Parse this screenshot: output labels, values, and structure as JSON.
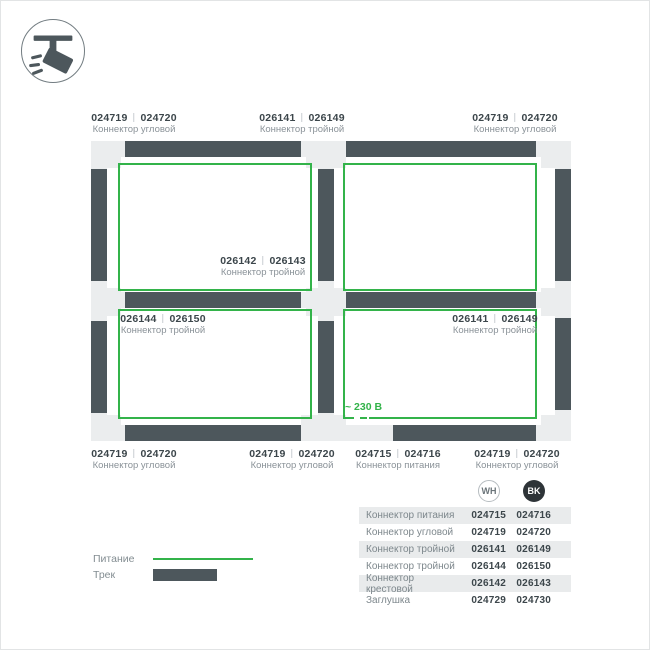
{
  "colors": {
    "power_green": "#33b34a",
    "track_dark": "#4d575c",
    "track_light": "#ebedee",
    "table_shade": "#e9ebec",
    "text_dark": "#3c464b",
    "text_gray": "#8a9298"
  },
  "icon": {
    "name": "track-spotlight"
  },
  "diagram": {
    "labels": [
      {
        "num1": "024719",
        "num2": "024720",
        "name": "Коннектор угловой"
      },
      {
        "num1": "026141",
        "num2": "026149",
        "name": "Коннектор тройной"
      },
      {
        "num1": "024719",
        "num2": "024720",
        "name": "Коннектор угловой"
      },
      {
        "num1": "026142",
        "num2": "026143",
        "name": "Коннектор тройной"
      },
      {
        "num1": "026144",
        "num2": "026150",
        "name": "Коннектор тройной"
      },
      {
        "num1": "026141",
        "num2": "026149",
        "name": "Коннектор тройной"
      },
      {
        "num1": "024719",
        "num2": "024720",
        "name": "Коннектор угловой"
      },
      {
        "num1": "024719",
        "num2": "024720",
        "name": "Коннектор угловой"
      },
      {
        "num1": "024715",
        "num2": "024716",
        "name": "Коннектор питания"
      },
      {
        "num1": "024719",
        "num2": "024720",
        "name": "Коннектор угловой"
      }
    ],
    "voltage_label": "~ 230 В"
  },
  "legend": {
    "power_label": "Питание",
    "track_label": "Трек"
  },
  "table": {
    "col_wh": "WH",
    "col_bk": "BK",
    "rows": [
      {
        "name": "Коннектор питания",
        "wh": "024715",
        "bk": "024716"
      },
      {
        "name": "Коннектор угловой",
        "wh": "024719",
        "bk": "024720"
      },
      {
        "name": "Коннектор тройной",
        "wh": "026141",
        "bk": "026149"
      },
      {
        "name": "Коннектор тройной",
        "wh": "026144",
        "bk": "026150"
      },
      {
        "name": "Коннектор крестовой",
        "wh": "026142",
        "bk": "026143"
      },
      {
        "name": "Заглушка",
        "wh": "024729",
        "bk": "024730"
      }
    ]
  }
}
